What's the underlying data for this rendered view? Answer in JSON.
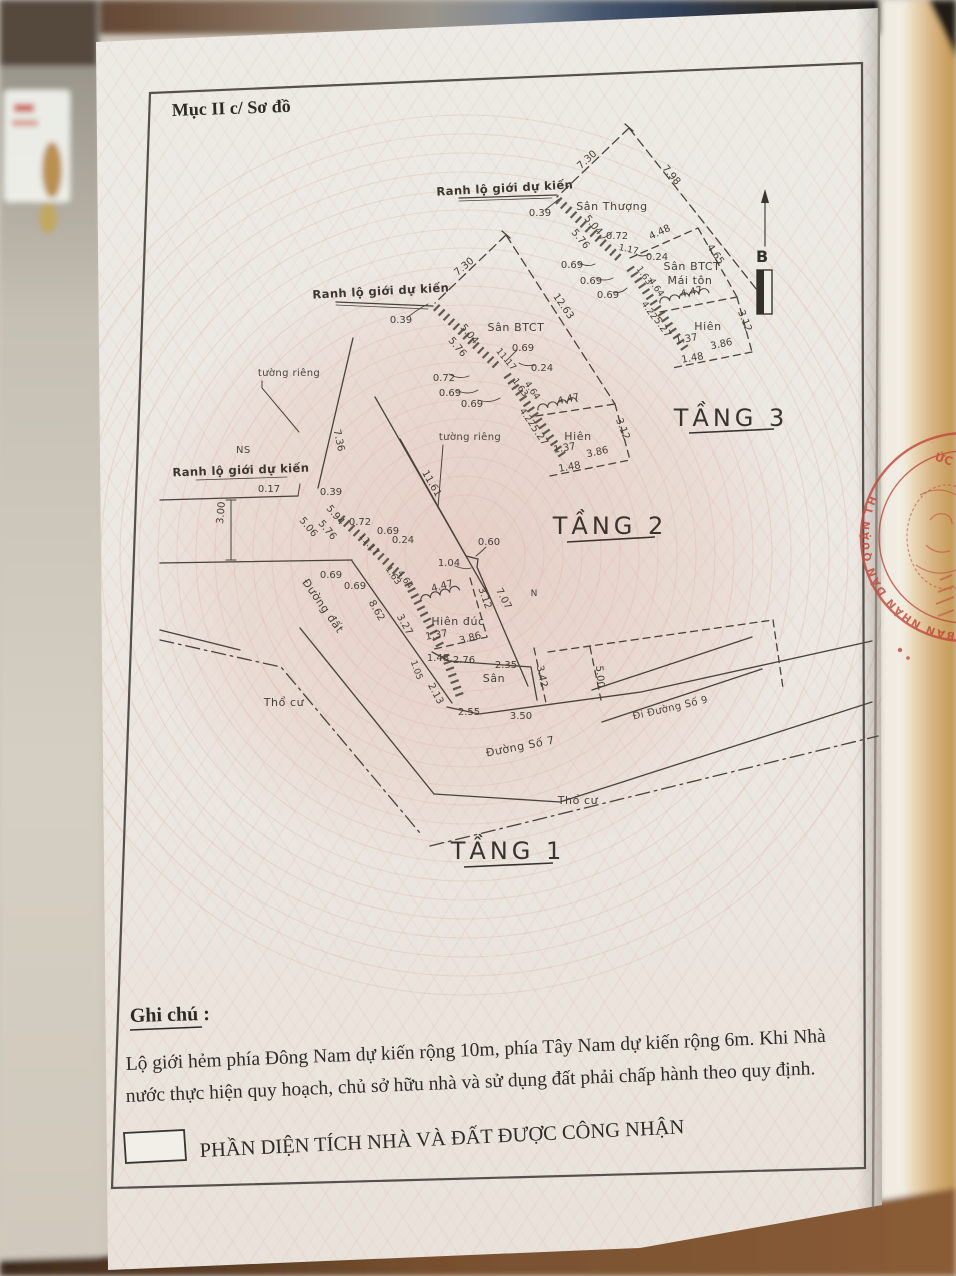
{
  "doc": {
    "section_title": "Mục II c/ Sơ đồ",
    "compass": {
      "north_label": "B"
    },
    "f3": {
      "title": "TẦNG 3",
      "boundary_label": "Ranh lộ giới dự kiến",
      "areas": {
        "san_thuong": "Sân Thượng",
        "san_btct": "Sân BTCT",
        "mai_ton": "Mái tôn",
        "hien": "Hiên"
      },
      "dims": [
        "0.39",
        "7.30",
        "7.98",
        "5.04",
        "5.76",
        "0.72",
        "0.69",
        "0.69",
        "0.69",
        "1.17",
        "0.24",
        "4.48",
        "4.65",
        "1.63",
        "4.64",
        "4.47",
        "3.12",
        "4.22",
        "5.27",
        "1.37",
        "3.86",
        "1.48"
      ]
    },
    "f2": {
      "title": "TẦNG 2",
      "boundary_label": "Ranh lộ giới dự kiến",
      "areas": {
        "san_btct": "Sân BTCT",
        "hien": "Hiên",
        "tuong_rieng": "tường riêng"
      },
      "dims": [
        "0.39",
        "7.30",
        "12.63",
        "5.04",
        "5.76",
        "11.17",
        "0.69",
        "0.24",
        "0.72",
        "0.69",
        "0.69",
        "1.63",
        "4.64",
        "4.47",
        "3.12",
        "4.22",
        "5.27",
        "1.37",
        "3.86",
        "1.48"
      ]
    },
    "f1": {
      "title": "TẦNG 1",
      "boundary_label": "Ranh lộ giới dự kiến",
      "areas": {
        "ns": "NS",
        "tuong_rieng": "tường riêng",
        "hien_duc": "Hiên đúc",
        "san": "Sân",
        "n": "N",
        "duong_dat": "Đường đất",
        "tho_cu_1": "Thổ cư",
        "tho_cu_2": "Thổ cư",
        "duong_so_7": "Đường Số 7",
        "di_duong_so_9": "Đi Đường Số 9"
      },
      "dims": [
        "0.17",
        "0.39",
        "3.00",
        "7.36",
        "5.94",
        "5.76",
        "5.06",
        "0.72",
        "0.69",
        "0.24",
        "11.17",
        "0.69",
        "0.69",
        "1.63",
        "4.64",
        "8.62",
        "3.27",
        "11.61",
        "0.60",
        "1.04",
        "4.47",
        "3.12",
        "7.07",
        "1.37",
        "3.86",
        "1.48",
        "2.76",
        "2.35",
        "3.42",
        "1.05",
        "2.13",
        "2.55",
        "3.50",
        "5.00"
      ]
    },
    "notes": {
      "heading": "Ghi chú :",
      "line1": "Lộ giới hẻm phía Đông Nam dự kiến rộng 10m, phía Tây Nam dự kiến rộng 6m. Khi Nhà",
      "line2": "nước thực hiện quy hoạch, chủ sở hữu nhà và sử dụng đất phải chấp hành theo quy định."
    },
    "legend": {
      "label": "PHẦN DIỆN TÍCH NHÀ VÀ ĐẤT ĐƯỢC CÔNG NHẬN"
    },
    "stamp": {
      "arc_text": "BAN NHÂN DÂN QUẬN TH",
      "fragment_text": "ỨC",
      "color": "#c14a3c"
    }
  }
}
